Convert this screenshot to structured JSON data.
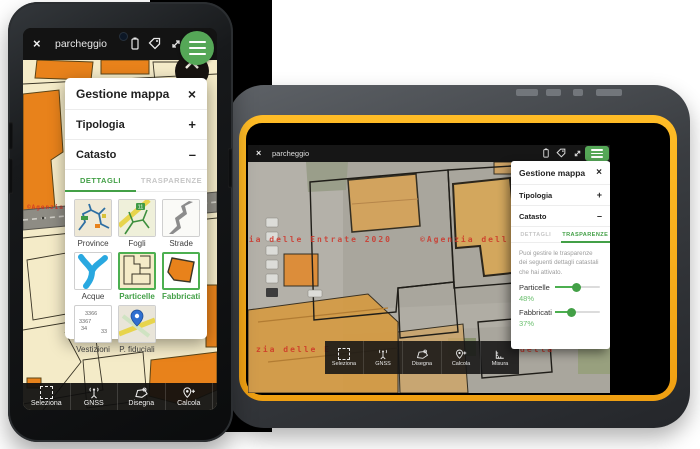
{
  "shared": {
    "app_title": "parcheggio",
    "panel_title": "Gestione mappa",
    "icons": {
      "close": "×",
      "plus": "+",
      "minus": "–"
    },
    "sections": [
      {
        "label": "Tipologia",
        "toggle": "+"
      },
      {
        "label": "Catasto",
        "toggle": "–"
      }
    ],
    "tabs": [
      {
        "label": "DETTAGLI"
      },
      {
        "label": "TRASPARENZE"
      }
    ],
    "toolbar": [
      {
        "label": "Seleziona"
      },
      {
        "label": "GNSS"
      },
      {
        "label": "Disegna"
      },
      {
        "label": "Calcola"
      },
      {
        "label": "Misura"
      }
    ],
    "watermark_full": "©Agenzia delle Entrate 2020",
    "colors": {
      "accent_green": "#4CAF50",
      "tab_green": "#43a047",
      "building_orange": "#e8821b",
      "trim_orange": "#f3a61c",
      "watermark_red": "#ce3024"
    }
  },
  "phone": {
    "active_tab": "DETTAGLI",
    "tiles": [
      {
        "label": "Province",
        "selected": false
      },
      {
        "label": "Fogli",
        "selected": false
      },
      {
        "label": "Strade",
        "selected": false
      },
      {
        "label": "Acque",
        "selected": false
      },
      {
        "label": "Particelle",
        "selected": true
      },
      {
        "label": "Fabbricati",
        "selected": true
      },
      {
        "label": "Vestizioni",
        "selected": false
      },
      {
        "label": "P. fiduciali",
        "selected": false
      }
    ],
    "fogli_badge": "11",
    "vestizioni_numbers": [
      "3366",
      "3367",
      "34",
      "33"
    ],
    "watermark_fragment": "©Agenzia de"
  },
  "tablet": {
    "active_tab": "TRASPARENZE",
    "panel": {
      "description": "Puoi gestire le trasparenze dei seguenti dettagli catastali che hai attivato.",
      "sliders": [
        {
          "label": "Particelle",
          "value": "48%",
          "percent": 48
        },
        {
          "label": "Fabbricati",
          "value": "37%",
          "percent": 37
        }
      ]
    },
    "watermark": {
      "line1_left": "zia delle Entrate 2020",
      "line1_right": "©Agenzia dell",
      "line2_left": "zia delle E",
      "line2_right": "della"
    }
  }
}
